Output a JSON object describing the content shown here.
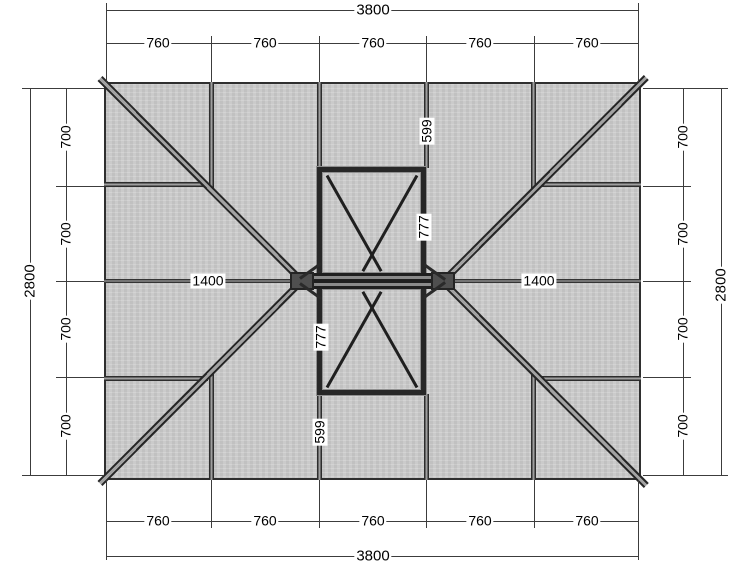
{
  "drawing": {
    "type": "hip roof framing plan with two cross-braced skylight openings",
    "top": {
      "total": "3800",
      "segments": [
        "760",
        "760",
        "760",
        "760",
        "760"
      ]
    },
    "bottom": {
      "total": "3800",
      "segments": [
        "760",
        "760",
        "760",
        "760",
        "760"
      ]
    },
    "left": {
      "total": "2800",
      "segments": [
        "700",
        "700",
        "700",
        "700"
      ]
    },
    "right": {
      "total": "2800",
      "segments": [
        "700",
        "700",
        "700",
        "700"
      ]
    },
    "ridge": {
      "left": "1400",
      "right": "1400"
    },
    "upper_opening": {
      "top_offset": "599",
      "height": "777"
    },
    "lower_opening": {
      "height": "777",
      "bottom_offset": "599"
    }
  },
  "colors": {
    "background": "#ffffff",
    "roof_fill": "#c9c9c9",
    "beam_dark": "#2d2d2d",
    "beam_core": "#9e9e9e",
    "dim_line": "#3c3c3c",
    "label_bg": "#ffffff",
    "label_text": "#000000"
  }
}
